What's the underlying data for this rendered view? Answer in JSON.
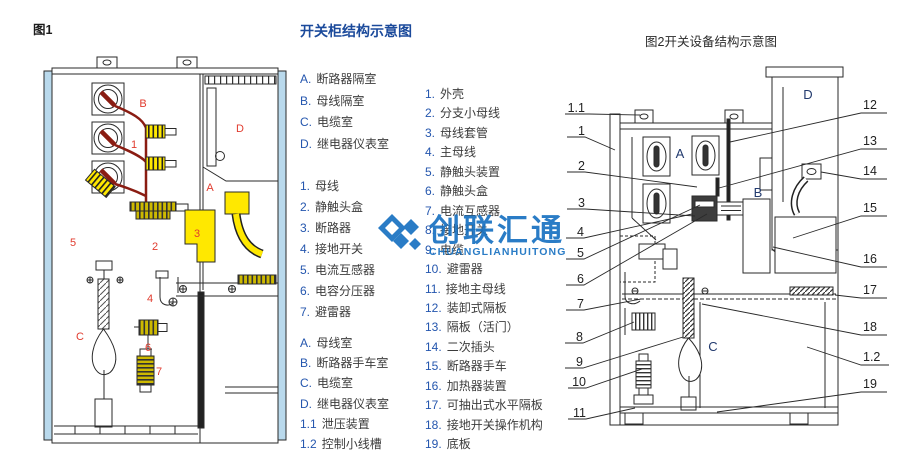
{
  "colors": {
    "title_blue": "#1b4a9b",
    "key_blue": "#2456ae",
    "mark_red": "#e13b2e",
    "wire_dark_red": "#8a1c12",
    "highlight_yellow": "#ffe800",
    "panel_light_blue": "#b9d9ec",
    "watermark_blue": "#1a73c2",
    "text_dark": "#3c3c3c"
  },
  "fig1": {
    "caption": "图1",
    "marks": {
      "A": "A",
      "B": "B",
      "C": "C",
      "D": "D",
      "1": "1",
      "2": "2",
      "3": "3",
      "4": "4",
      "5": "5",
      "6": "6",
      "7": "7"
    }
  },
  "legend": {
    "title": "开关柜结构示意图",
    "compartments1": [
      {
        "k": "A.",
        "t": "断路器隔室"
      },
      {
        "k": "B.",
        "t": "母线隔室"
      },
      {
        "k": "C.",
        "t": "电缆室"
      },
      {
        "k": "D.",
        "t": "继电器仪表室"
      }
    ],
    "parts1": [
      {
        "k": "1.",
        "t": "母线"
      },
      {
        "k": "2.",
        "t": "静触头盒"
      },
      {
        "k": "3.",
        "t": "断路器"
      },
      {
        "k": "4.",
        "t": "接地开关"
      },
      {
        "k": "5.",
        "t": "电流互感器"
      },
      {
        "k": "6.",
        "t": "电容分压器"
      },
      {
        "k": "7.",
        "t": "避雷器"
      }
    ],
    "compartments2": [
      {
        "k": "A.",
        "t": "母线室"
      },
      {
        "k": "B.",
        "t": "断路器手车室"
      },
      {
        "k": "C.",
        "t": "电缆室"
      },
      {
        "k": "D.",
        "t": "继电器仪表室"
      },
      {
        "k": "1.1",
        "t": "泄压装置"
      },
      {
        "k": "1.2",
        "t": "控制小线槽"
      }
    ],
    "parts2": [
      {
        "k": "1.",
        "t": "外壳"
      },
      {
        "k": "2.",
        "t": "分支小母线"
      },
      {
        "k": "3.",
        "t": "母线套管"
      },
      {
        "k": "4.",
        "t": "主母线"
      },
      {
        "k": "5.",
        "t": "静触头装置"
      },
      {
        "k": "6.",
        "t": "静触头盒"
      },
      {
        "k": "7.",
        "t": "电流互感器"
      },
      {
        "k": "8.",
        "t": "接地开关"
      },
      {
        "k": "9.",
        "t": "电缆"
      },
      {
        "k": "10.",
        "t": "避雷器"
      },
      {
        "k": "11.",
        "t": "接地主母线"
      },
      {
        "k": "12.",
        "t": "装卸式隔板"
      },
      {
        "k": "13.",
        "t": "隔板（活门）"
      },
      {
        "k": "14.",
        "t": "二次插头"
      },
      {
        "k": "15.",
        "t": "断路器手车"
      },
      {
        "k": "16.",
        "t": "加热器装置"
      },
      {
        "k": "17.",
        "t": "可抽出式水平隔板"
      },
      {
        "k": "18.",
        "t": "接地开关操作机构"
      },
      {
        "k": "19.",
        "t": "底板"
      }
    ]
  },
  "fig2": {
    "caption": "图2开关设备结构示意图",
    "left_labels": [
      "1.1",
      "1",
      "2",
      "3",
      "4",
      "5",
      "6",
      "7",
      "8",
      "9",
      "10",
      "11"
    ],
    "right_labels": [
      "12",
      "13",
      "14",
      "15",
      "16",
      "17",
      "18",
      "1.2",
      "19"
    ],
    "marks": {
      "A": "A",
      "B": "B",
      "C": "C",
      "D": "D"
    }
  },
  "watermark": {
    "cjk": "创联汇通",
    "latin": "CHUANGLIANHUITONG"
  }
}
